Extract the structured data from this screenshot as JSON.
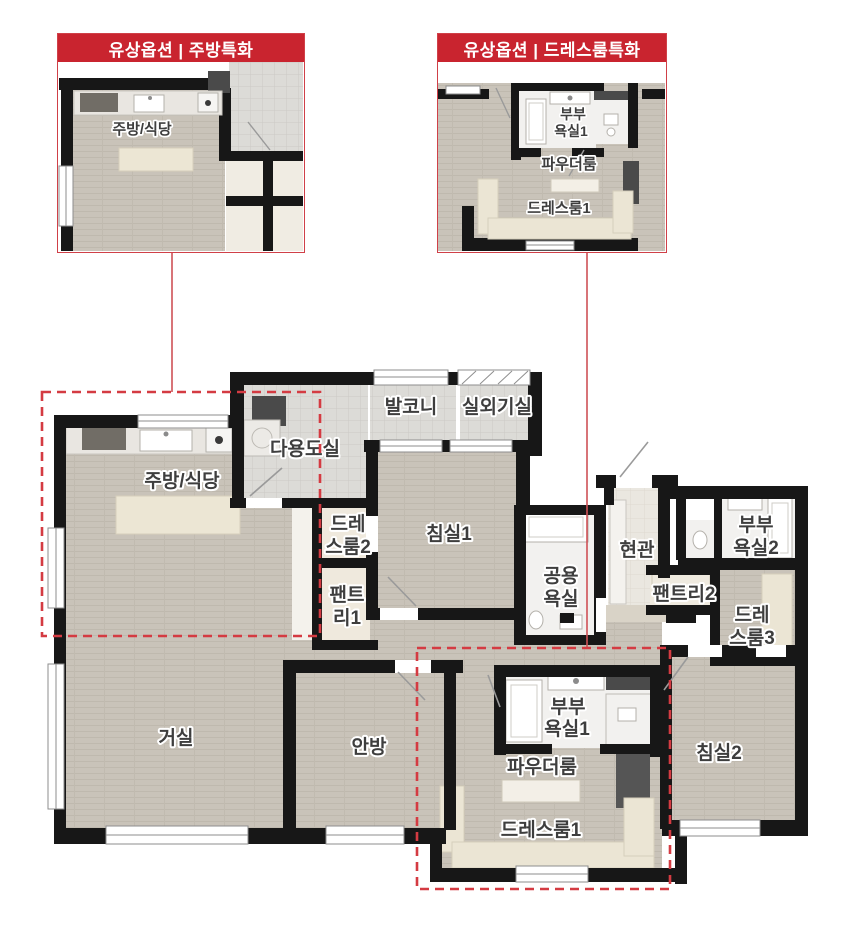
{
  "colors": {
    "accent_red": "#c9242f",
    "callout_border_red": "#d04048",
    "dashed_red": "#d43b42",
    "connector_red": "#cf5156",
    "wall_black": "#171717",
    "wood_floor": "#c9c3b9",
    "tile_floor": "#dcdbd7",
    "entry_floor": "#eae7e0",
    "bath_floor": "#f2f1ef",
    "furniture_cream": "#ebe5d4",
    "appliance_dark": "#4a4a4a",
    "label_gray": "#3e3e3e"
  },
  "callout_kitchen": {
    "title": "유상옵션 | 주방특화",
    "room_label": "주방/식당"
  },
  "callout_dressroom": {
    "title": "유상옵션 | 드레스룸특화",
    "master_bath_l1": "부부",
    "master_bath_l2": "욕실1",
    "powder_room": "파우더룸",
    "dress_room": "드레스룸1"
  },
  "floor_plan": {
    "utility_room": "다용도실",
    "balcony": "발코니",
    "outdoor_unit_room": "실외기실",
    "kitchen_dining": "주방/식당",
    "dress2_l1": "드레",
    "dress2_l2": "스룸2",
    "bedroom1": "침실1",
    "pantry1_l1": "팬트",
    "pantry1_l2": "리1",
    "common_bath_l1": "공용",
    "common_bath_l2": "욕실",
    "entrance": "현관",
    "master_bath2_l1": "부부",
    "master_bath2_l2": "욕실2",
    "pantry2": "팬트리2",
    "dress3_l1": "드레",
    "dress3_l2": "스룸3",
    "living_room": "거실",
    "master_bedroom": "안방",
    "master_bath1_l1": "부부",
    "master_bath1_l2": "욕실1",
    "powder_room": "파우더룸",
    "dress1": "드레스룸1",
    "bedroom2": "침실2"
  }
}
